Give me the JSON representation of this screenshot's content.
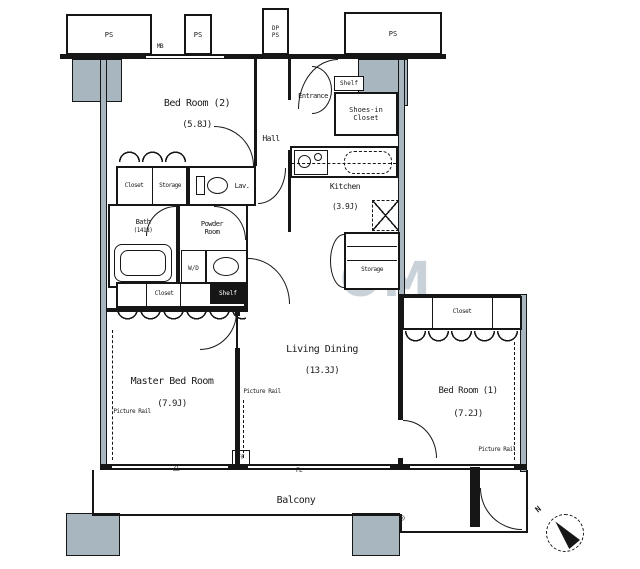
{
  "plan": {
    "shafts": {
      "ps": "PS",
      "dp_ps": "DP\nPS",
      "meter": "MB"
    },
    "rooms": {
      "bedroom2": {
        "name": "Bed Room (2)",
        "size": "(5.8J)"
      },
      "entrance": {
        "name": "Entrance"
      },
      "hall": {
        "name": "Hall"
      },
      "shoes_closet": {
        "name": "Shoes-in\nCloset"
      },
      "kitchen": {
        "name": "Kitchen",
        "size": "(3.9J)"
      },
      "bath": {
        "name": "Bath",
        "size": "(1418)"
      },
      "powder": {
        "name": "Powder\nRoom"
      },
      "lavatory": {
        "name": "Lav."
      },
      "living_dining": {
        "name": "Living Dining",
        "size": "(13.3J)"
      },
      "master_bedroom": {
        "name": "Master Bed Room",
        "size": "(7.9J)"
      },
      "bedroom1": {
        "name": "Bed Room (1)",
        "size": "(7.2J)"
      },
      "balcony": {
        "name": "Balcony"
      }
    },
    "storage": {
      "closet": "Closet",
      "storage": "Storage",
      "shelf": "Shelf"
    },
    "fixtures": {
      "washer_dryer": "W/D",
      "ff_vent": "FF",
      "floor_level": "FL"
    },
    "annotations": {
      "picture_rail": "Picture Rail",
      "north": "N",
      "evac_hatch": "△",
      "drain": "◎",
      "watermark": "OM"
    },
    "colors": {
      "line": "#1a1a1a",
      "column_fill": "#a8b6c0",
      "watermark": "#b9c6cf"
    }
  }
}
